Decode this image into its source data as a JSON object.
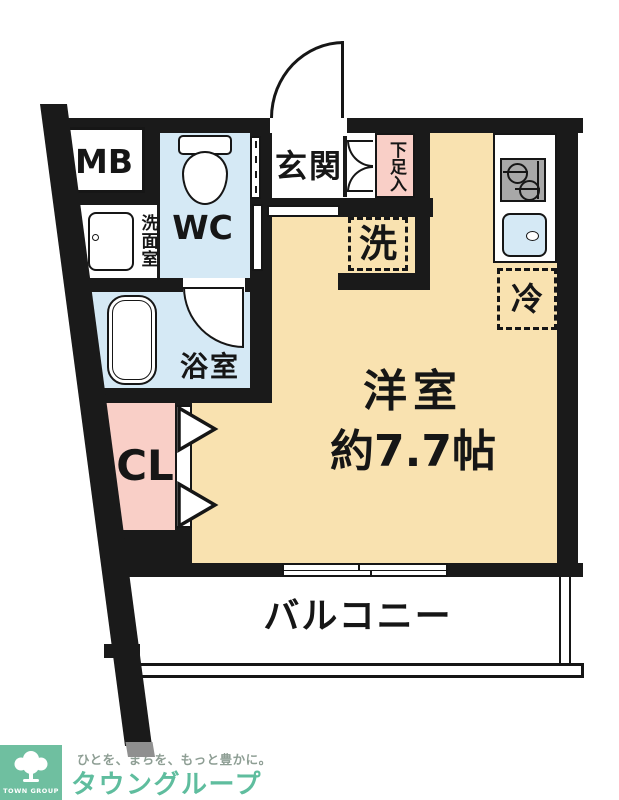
{
  "floor_plan": {
    "labels": {
      "meter_box": "MB",
      "toilet_room": "WC",
      "washroom": "洗面室",
      "entrance": "玄関",
      "shoe_cabinet": "下足入",
      "washer_space": "洗",
      "fridge_space": "冷",
      "bathroom": "浴室",
      "closet": "CL",
      "main_room_name": "洋室",
      "main_room_size": "約7.7帖",
      "balcony": "バルコニー"
    },
    "colors": {
      "wall": "#1a1a1a",
      "room_floor": "#F9E2B0",
      "wet_area": "#D5E9F5",
      "storage": "#F9CFC7",
      "stove": "#A8A8A8"
    }
  },
  "branding": {
    "logo_block_text": "TOWN GROUP",
    "tagline": "ひとを、まちを、もっと豊かに。",
    "company_name": "タウングループ",
    "colors": {
      "logo_bg": "#6FBFA0",
      "company_text": "#5FBD9E",
      "tagline_text": "#8E9E94"
    }
  }
}
